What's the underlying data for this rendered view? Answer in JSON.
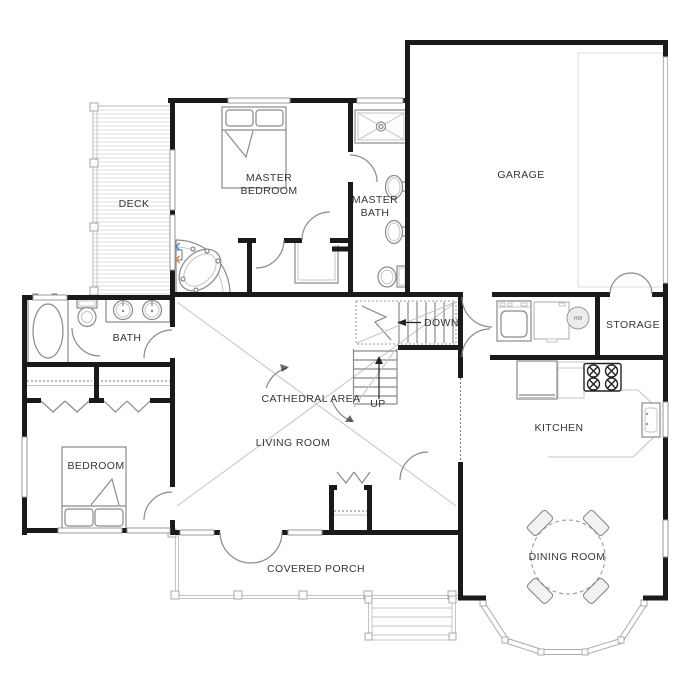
{
  "rooms": {
    "deck": "DECK",
    "master_bedroom": [
      "MASTER",
      "BEDROOM"
    ],
    "master_bath": [
      "MASTER",
      "BATH"
    ],
    "garage": "GARAGE",
    "storage": "STORAGE",
    "kitchen": "KITCHEN",
    "bath": "BATH",
    "bedroom": "BEDROOM",
    "cathedral_area": "CATHEDRAL AREA",
    "living_room": "LIVING ROOM",
    "dining_room": "DINING ROOM",
    "covered_porch": "COVERED PORCH"
  },
  "annotations": {
    "stairs_down": "DOWN",
    "stairs_up": "UP",
    "water_heater": "HW"
  },
  "colors": {
    "wall": "#1a1a1a",
    "fixture_line": "#8a8a8a",
    "light_line": "#c4c4c4",
    "label_text": "#36363c",
    "hot_faucet": "#e08030",
    "cold_faucet": "#3b7dd8",
    "background": "#ffffff"
  }
}
